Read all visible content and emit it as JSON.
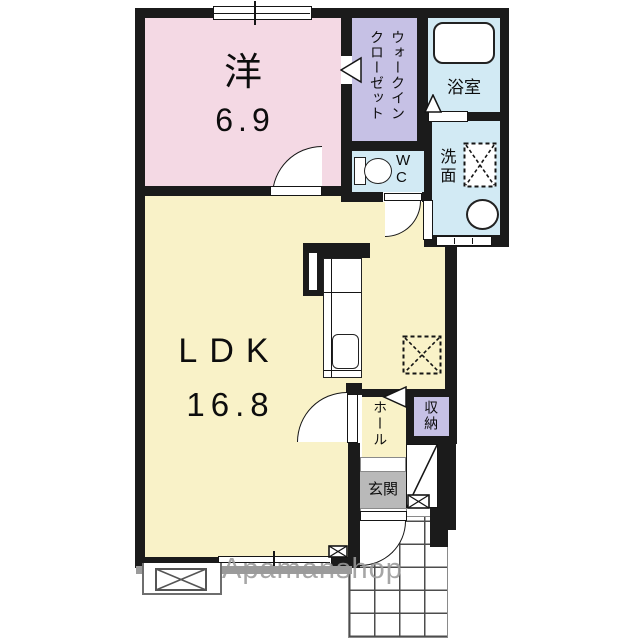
{
  "watermark": "Apamanshop",
  "rooms": {
    "western": {
      "name": "洋",
      "size": "6.9"
    },
    "wic": {
      "name": "ウォークインクローゼット"
    },
    "bathroom": {
      "name": "浴室"
    },
    "toilet": {
      "name": "WC"
    },
    "washroom": {
      "name": "洗面"
    },
    "ldk": {
      "name": "LDK",
      "size": "16.8"
    },
    "hall": {
      "name": "ホール"
    },
    "storage": {
      "name": "収納"
    },
    "entrance": {
      "name": "玄関"
    }
  },
  "colors": {
    "wall": "#1b1b1b",
    "western_room": "#f4d9e4",
    "closet": "#c6c1e5",
    "wet_area": "#d2eaf4",
    "ldk": "#f9f2c8",
    "entrance_floor": "#b9b9b9",
    "watermark": "#9a9a9a"
  }
}
